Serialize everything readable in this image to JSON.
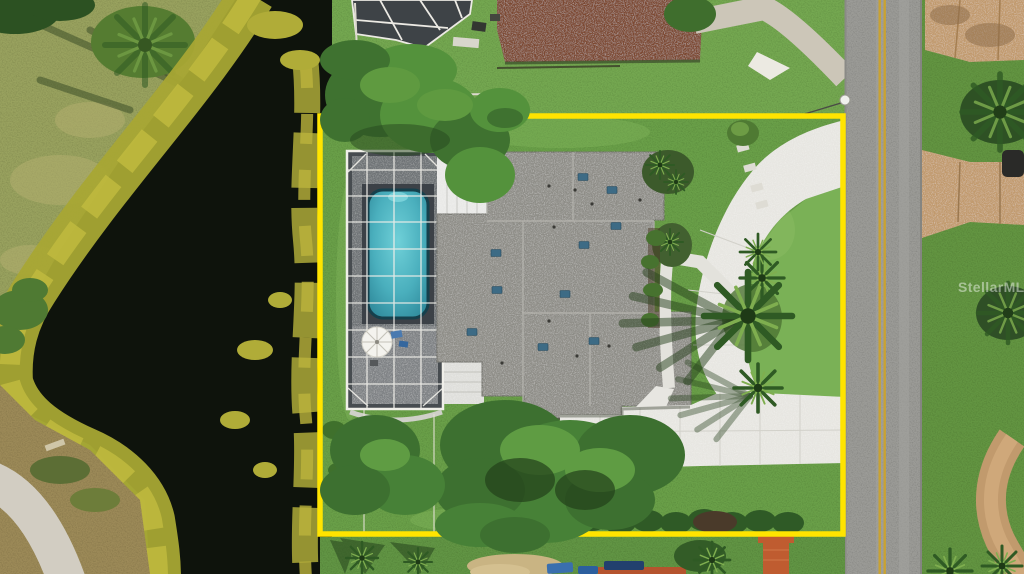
{
  "watermark": {
    "text": "StellarMLS"
  },
  "colors": {
    "boundary_yellow": "#ffe400",
    "lawn_green": "#6aa04a",
    "canal_water": "#0e130c",
    "algae_green": "#a8a634",
    "roof_gray": "#8e8d87",
    "pool_water": "#4ab0bd",
    "driveway_concrete": "#e7e6e1",
    "road_asphalt": "#9b9b97",
    "road_stripe_yellow": "#c9a232",
    "neighbor_roof_brown": "#7d4a33",
    "tan_driveway": "#c19a6d",
    "screen_enclosure_gray": "#474c50",
    "watermark_white": "#ffffff"
  }
}
